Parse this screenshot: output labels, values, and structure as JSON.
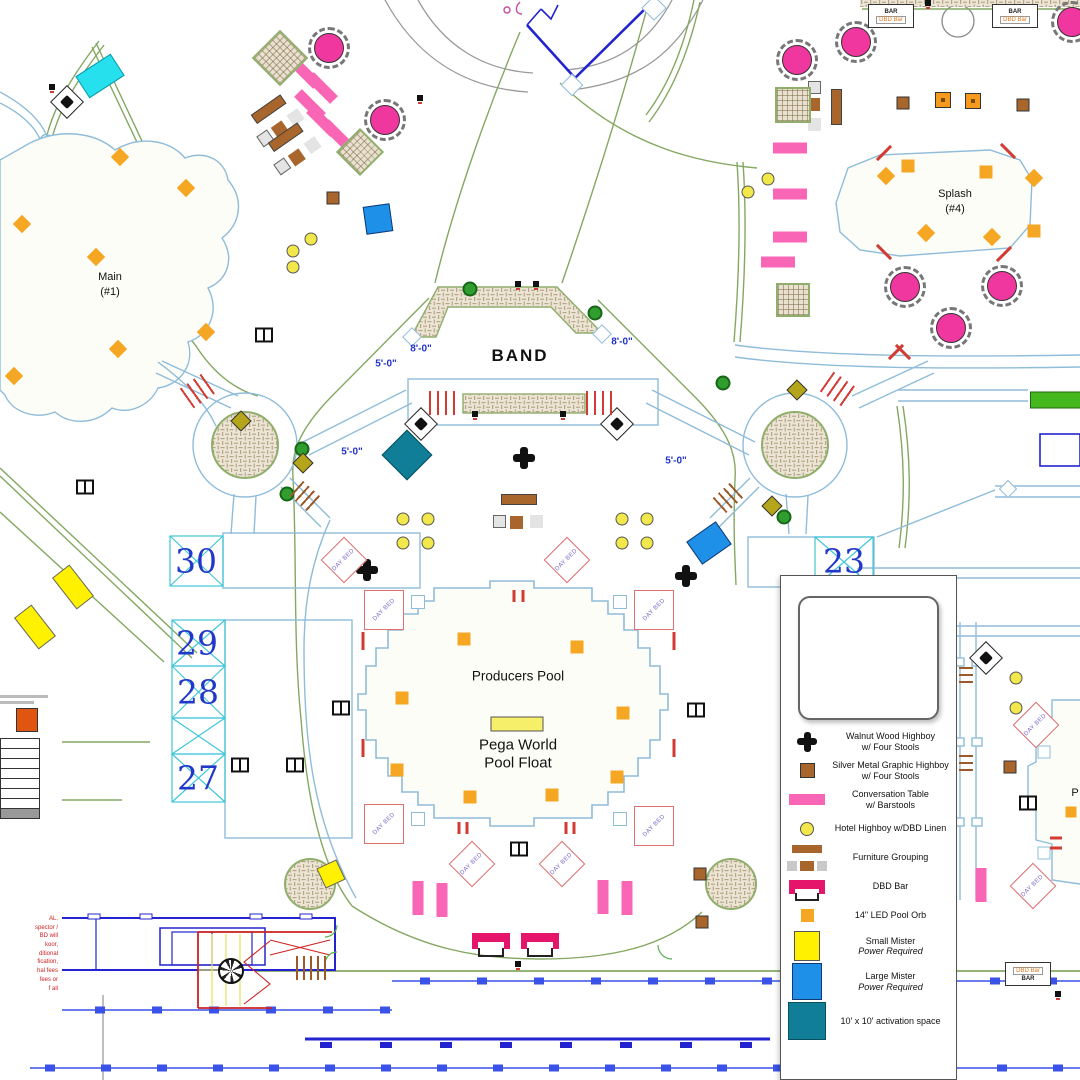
{
  "colors": {
    "pink": "#f966b5",
    "magenta_table": "#f0379f",
    "dbd_bar": "#e4156b",
    "orb_orange": "#f5a623",
    "brown": "#a9662c",
    "small_mister": "#fff100",
    "large_mister": "#1e90e8",
    "activation": "#0f7e96",
    "walk_green": "#84a861",
    "water_blue": "#8fbcd9",
    "cad_blue": "#2323cf",
    "cabana_num": "#2238c8",
    "red": "#d23b33"
  },
  "day_bed_text": "DAY BED",
  "bar_icon": {
    "bar": "BAR",
    "dbd": "DBD Bar"
  },
  "labels": [
    {
      "text": "BAND",
      "x": 520,
      "y": 356,
      "cls": "band"
    },
    {
      "text": "Producers Pool",
      "x": 518,
      "y": 676,
      "cls": "pool"
    },
    {
      "text": "Pega World",
      "x": 518,
      "y": 745,
      "cls": "float"
    },
    {
      "text": "Pool Float",
      "x": 518,
      "y": 763,
      "cls": "float"
    },
    {
      "text": "Main",
      "x": 110,
      "y": 277,
      "cls": "small"
    },
    {
      "text": "(#1)",
      "x": 110,
      "y": 292,
      "cls": "small"
    },
    {
      "text": "Splash",
      "x": 955,
      "y": 194,
      "cls": "small"
    },
    {
      "text": "(#4)",
      "x": 955,
      "y": 209,
      "cls": "small"
    },
    {
      "text": "30",
      "x": 196,
      "y": 561,
      "cls": "cab"
    },
    {
      "text": "29",
      "x": 197,
      "y": 643,
      "cls": "cab"
    },
    {
      "text": "28",
      "x": 198,
      "y": 692,
      "cls": "cab"
    },
    {
      "text": "27",
      "x": 198,
      "y": 778,
      "cls": "cab"
    },
    {
      "text": "23",
      "x": 844,
      "y": 561,
      "cls": "cab"
    },
    {
      "text": "8'-0\"",
      "x": 421,
      "y": 349,
      "cls": "dim"
    },
    {
      "text": "8'-0\"",
      "x": 622,
      "y": 342,
      "cls": "dim"
    },
    {
      "text": "5'-0\"",
      "x": 386,
      "y": 364,
      "cls": "dim"
    },
    {
      "text": "5'-0\"",
      "x": 352,
      "y": 452,
      "cls": "dim"
    },
    {
      "text": "5'-0\"",
      "x": 676,
      "y": 461,
      "cls": "dim"
    },
    {
      "text": "P",
      "x": 1075,
      "y": 793,
      "cls": "small"
    }
  ],
  "legend": {
    "items": [
      {
        "swatch": "plus",
        "line1": "Walnut Wood Highboy",
        "line2": "w/ Four Stools"
      },
      {
        "swatch": "brown",
        "line1": "Silver Metal Graphic Highboy",
        "line2": "w/ Four Stools"
      },
      {
        "swatch": "pink",
        "line1": "Conversation Table",
        "line2": "w/ Barstools"
      },
      {
        "swatch": "ycirc",
        "line1": "Hotel Highboy w/DBD Linen"
      },
      {
        "swatch": "furn",
        "line1": "Furniture Grouping"
      },
      {
        "swatch": "dbd",
        "line1": "DBD Bar"
      },
      {
        "swatch": "orange",
        "line1": "14\" LED Pool Orb"
      },
      {
        "swatch": "yrect",
        "line1": "Small Mister",
        "line2": "Power Required",
        "italic2": true
      },
      {
        "swatch": "brect",
        "line1": "Large Mister",
        "line2": "Power Required",
        "italic2": true
      },
      {
        "swatch": "teal",
        "line1": "10' x 10' activation space"
      }
    ]
  },
  "notes_panel": {
    "table_rows": 8,
    "red_fragments": [
      "AL.",
      "spector /",
      "BD will",
      "koor,",
      "ditional",
      "fication,",
      "hal fees",
      "fees or",
      "f all"
    ]
  },
  "markers": [
    {
      "t": "orb",
      "x": 464,
      "y": 639
    },
    {
      "t": "orb",
      "x": 577,
      "y": 647
    },
    {
      "t": "orb",
      "x": 402,
      "y": 698
    },
    {
      "t": "orb",
      "x": 623,
      "y": 713
    },
    {
      "t": "orb",
      "x": 397,
      "y": 770
    },
    {
      "t": "orb",
      "x": 617,
      "y": 777
    },
    {
      "t": "orb",
      "x": 470,
      "y": 797
    },
    {
      "t": "orb",
      "x": 552,
      "y": 795
    },
    {
      "t": "orb",
      "x": 1071,
      "y": 812,
      "w": 11,
      "h": 11
    },
    {
      "t": "orbd",
      "x": 120,
      "y": 157,
      "r": 45
    },
    {
      "t": "orbd",
      "x": 22,
      "y": 224,
      "r": 45
    },
    {
      "t": "orbd",
      "x": 96,
      "y": 257,
      "r": 45
    },
    {
      "t": "orbd",
      "x": 14,
      "y": 376,
      "r": 45
    },
    {
      "t": "orbd",
      "x": 118,
      "y": 349,
      "r": 45
    },
    {
      "t": "orbd",
      "x": 206,
      "y": 332,
      "r": 45
    },
    {
      "t": "orbd",
      "x": 186,
      "y": 188,
      "r": 45
    },
    {
      "t": "orbd",
      "x": 886,
      "y": 176,
      "r": 45
    },
    {
      "t": "orb",
      "x": 908,
      "y": 166
    },
    {
      "t": "orb",
      "x": 986,
      "y": 172
    },
    {
      "t": "orbd",
      "x": 1034,
      "y": 178,
      "r": 45
    },
    {
      "t": "orbd",
      "x": 926,
      "y": 233,
      "r": 45
    },
    {
      "t": "orbd",
      "x": 992,
      "y": 237,
      "r": 45
    },
    {
      "t": "orb",
      "x": 1034,
      "y": 231
    },
    {
      "t": "float",
      "x": 517,
      "y": 724
    },
    {
      "t": "ptable",
      "x": 329,
      "y": 48
    },
    {
      "t": "ptable",
      "x": 385,
      "y": 120
    },
    {
      "t": "ptable",
      "x": 797,
      "y": 60
    },
    {
      "t": "ptable",
      "x": 856,
      "y": 42
    },
    {
      "t": "ptable",
      "x": 1072,
      "y": 22
    },
    {
      "t": "ptable",
      "x": 905,
      "y": 287
    },
    {
      "t": "ptable",
      "x": 951,
      "y": 328
    },
    {
      "t": "ptable",
      "x": 1002,
      "y": 286
    },
    {
      "t": "conv",
      "x": 305,
      "y": 73,
      "r": 45
    },
    {
      "t": "conv",
      "x": 322,
      "y": 88,
      "r": 45
    },
    {
      "t": "conv",
      "x": 310,
      "y": 105,
      "r": 45
    },
    {
      "t": "conv",
      "x": 322,
      "y": 121,
      "r": 45
    },
    {
      "t": "conv",
      "x": 337,
      "y": 135,
      "r": 45
    },
    {
      "t": "conv",
      "x": 790,
      "y": 148
    },
    {
      "t": "conv",
      "x": 790,
      "y": 194
    },
    {
      "t": "conv",
      "x": 790,
      "y": 237
    },
    {
      "t": "conv",
      "x": 778,
      "y": 262
    },
    {
      "t": "conv",
      "x": 418,
      "y": 898,
      "r": 90
    },
    {
      "t": "conv",
      "x": 442,
      "y": 900,
      "r": 90
    },
    {
      "t": "conv",
      "x": 603,
      "y": 897,
      "r": 90
    },
    {
      "t": "conv",
      "x": 627,
      "y": 898,
      "r": 90
    },
    {
      "t": "conv",
      "x": 981,
      "y": 885,
      "r": 90
    },
    {
      "t": "tree",
      "x": 470,
      "y": 289
    },
    {
      "t": "tree",
      "x": 595,
      "y": 313
    },
    {
      "t": "tree",
      "x": 723,
      "y": 383
    },
    {
      "t": "tree",
      "x": 302,
      "y": 449
    },
    {
      "t": "tree",
      "x": 287,
      "y": 494
    },
    {
      "t": "tree",
      "x": 784,
      "y": 517
    },
    {
      "t": "ybh",
      "x": 403,
      "y": 519
    },
    {
      "t": "ybh",
      "x": 428,
      "y": 519
    },
    {
      "t": "ybh",
      "x": 403,
      "y": 543
    },
    {
      "t": "ybh",
      "x": 428,
      "y": 543
    },
    {
      "t": "ybh",
      "x": 622,
      "y": 519
    },
    {
      "t": "ybh",
      "x": 647,
      "y": 519
    },
    {
      "t": "ybh",
      "x": 622,
      "y": 543
    },
    {
      "t": "ybh",
      "x": 647,
      "y": 543
    },
    {
      "t": "ybh",
      "x": 293,
      "y": 251
    },
    {
      "t": "ybh",
      "x": 311,
      "y": 239
    },
    {
      "t": "ybh",
      "x": 293,
      "y": 267
    },
    {
      "t": "ybh",
      "x": 748,
      "y": 192
    },
    {
      "t": "ybh",
      "x": 768,
      "y": 179
    },
    {
      "t": "ybh",
      "x": 1016,
      "y": 678
    },
    {
      "t": "ybh",
      "x": 1016,
      "y": 708
    },
    {
      "t": "olive",
      "x": 241,
      "y": 421,
      "r": 45
    },
    {
      "t": "olive",
      "x": 303,
      "y": 463,
      "r": 45
    },
    {
      "t": "olive",
      "x": 797,
      "y": 390,
      "r": 45
    },
    {
      "t": "olive",
      "x": 772,
      "y": 506,
      "r": 45
    },
    {
      "t": "plus",
      "x": 524,
      "y": 458
    },
    {
      "t": "plus",
      "x": 367,
      "y": 570
    },
    {
      "t": "plus",
      "x": 686,
      "y": 576
    },
    {
      "t": "daybed",
      "x": 384,
      "y": 610
    },
    {
      "t": "daybed",
      "x": 654,
      "y": 610
    },
    {
      "t": "daybed",
      "x": 384,
      "y": 824
    },
    {
      "t": "daybed",
      "x": 654,
      "y": 826
    },
    {
      "t": "daybedd",
      "x": 472,
      "y": 864,
      "r": 45
    },
    {
      "t": "daybedd",
      "x": 562,
      "y": 864,
      "r": 45
    },
    {
      "t": "daybedd",
      "x": 344,
      "y": 560,
      "r": 45
    },
    {
      "t": "daybedd",
      "x": 567,
      "y": 560,
      "r": 45
    },
    {
      "t": "daybedd",
      "x": 1036,
      "y": 725,
      "r": 45
    },
    {
      "t": "daybedd",
      "x": 1033,
      "y": 886,
      "r": 45
    },
    {
      "t": "bluesq",
      "x": 418,
      "y": 602
    },
    {
      "t": "bluesq",
      "x": 620,
      "y": 602
    },
    {
      "t": "bluesq",
      "x": 418,
      "y": 819
    },
    {
      "t": "bluesq",
      "x": 620,
      "y": 819
    },
    {
      "t": "bluesq",
      "x": 1044,
      "y": 752,
      "w": 13,
      "h": 13
    },
    {
      "t": "bluesq",
      "x": 1044,
      "y": 853,
      "w": 13,
      "h": 13
    },
    {
      "t": "bluesq",
      "x": 51,
      "y": 846,
      "w": 12,
      "h": 12
    },
    {
      "t": "bluesq",
      "x": 50,
      "y": 893,
      "w": 12,
      "h": 12
    },
    {
      "t": "bluesq",
      "x": 572,
      "y": 85,
      "w": 16,
      "h": 16,
      "r": 45
    },
    {
      "t": "bluesq",
      "x": 654,
      "y": 8,
      "w": 18,
      "h": 18,
      "r": 45
    },
    {
      "t": "bluesq",
      "x": 412,
      "y": 337,
      "w": 14,
      "h": 14,
      "r": 45
    },
    {
      "t": "bluesq",
      "x": 602,
      "y": 334,
      "w": 14,
      "h": 14,
      "r": 45
    },
    {
      "t": "bluesq",
      "x": 1008,
      "y": 489,
      "w": 13,
      "h": 13,
      "r": 45
    },
    {
      "t": "ymist",
      "x": 73,
      "y": 587,
      "r": -38
    },
    {
      "t": "ymist",
      "x": 35,
      "y": 627,
      "r": -38
    },
    {
      "t": "ymist",
      "x": 331,
      "y": 874,
      "w": 22,
      "h": 22,
      "r": -25
    },
    {
      "t": "cmist",
      "x": 100,
      "y": 76,
      "r": -33
    },
    {
      "t": "bmist",
      "x": 378,
      "y": 219,
      "r": -8
    },
    {
      "t": "bmist",
      "x": 709,
      "y": 543,
      "w": 36,
      "h": 28,
      "r": -35
    },
    {
      "t": "act",
      "x": 407,
      "y": 455,
      "r": 45
    },
    {
      "t": "dbdbar",
      "x": 491,
      "y": 941
    },
    {
      "t": "dbdbar",
      "x": 540,
      "y": 941
    },
    {
      "t": "baricon",
      "x": 891,
      "y": 16
    },
    {
      "t": "baricon",
      "x": 1015,
      "y": 16
    },
    {
      "t": "baricon2",
      "x": 1028,
      "y": 974
    },
    {
      "t": "tv",
      "x": 264,
      "y": 335
    },
    {
      "t": "tv",
      "x": 85,
      "y": 487
    },
    {
      "t": "tv",
      "x": 240,
      "y": 765
    },
    {
      "t": "tv",
      "x": 295,
      "y": 765
    },
    {
      "t": "tv",
      "x": 341,
      "y": 708
    },
    {
      "t": "tv",
      "x": 696,
      "y": 710
    },
    {
      "t": "tv",
      "x": 519,
      "y": 849
    },
    {
      "t": "tv",
      "x": 1028,
      "y": 803
    },
    {
      "t": "spk",
      "x": 67,
      "y": 102,
      "r": 45
    },
    {
      "t": "spk",
      "x": 421,
      "y": 424,
      "r": 45
    },
    {
      "t": "spk",
      "x": 617,
      "y": 424,
      "r": 45
    },
    {
      "t": "spk",
      "x": 986,
      "y": 658,
      "r": 45
    },
    {
      "t": "sofa",
      "x": 275,
      "y": 120,
      "r": -35
    },
    {
      "t": "sofa",
      "x": 292,
      "y": 148,
      "r": -35
    },
    {
      "t": "sofa",
      "x": 824,
      "y": 106,
      "r": 90
    },
    {
      "t": "sofa",
      "x": 518,
      "y": 512
    },
    {
      "t": "hatchd",
      "x": 280,
      "y": 58,
      "w": 40,
      "h": 40,
      "r": 45
    },
    {
      "t": "hatchd",
      "x": 360,
      "y": 152,
      "w": 34,
      "h": 34,
      "r": 45
    },
    {
      "t": "hatchd",
      "x": 793,
      "y": 105,
      "w": 36,
      "h": 36
    },
    {
      "t": "hatchd",
      "x": 793,
      "y": 300,
      "w": 34,
      "h": 34
    },
    {
      "t": "bsq",
      "x": 903,
      "y": 103
    },
    {
      "t": "bsq",
      "x": 1023,
      "y": 105
    },
    {
      "t": "bsq",
      "x": 700,
      "y": 874
    },
    {
      "t": "bsq",
      "x": 702,
      "y": 922
    },
    {
      "t": "bsq",
      "x": 333,
      "y": 198
    },
    {
      "t": "bsq",
      "x": 1010,
      "y": 767
    },
    {
      "t": "obox",
      "x": 943,
      "y": 100
    },
    {
      "t": "obox",
      "x": 973,
      "y": 101
    },
    {
      "t": "esym",
      "x": 518,
      "y": 284
    },
    {
      "t": "esym",
      "x": 536,
      "y": 284
    },
    {
      "t": "esym",
      "x": 475,
      "y": 414
    },
    {
      "t": "esym",
      "x": 563,
      "y": 414
    },
    {
      "t": "esym",
      "x": 518,
      "y": 964
    },
    {
      "t": "esym",
      "x": 848,
      "y": 964
    },
    {
      "t": "esym",
      "x": 1058,
      "y": 994
    },
    {
      "t": "esym",
      "x": 420,
      "y": 98
    },
    {
      "t": "esym",
      "x": 928,
      "y": 3
    },
    {
      "t": "esym",
      "x": 52,
      "y": 87
    },
    {
      "t": "redtick",
      "x": 363,
      "y": 641
    },
    {
      "t": "redtick",
      "x": 363,
      "y": 748
    },
    {
      "t": "redtick",
      "x": 674,
      "y": 641
    },
    {
      "t": "redtick",
      "x": 674,
      "y": 748
    },
    {
      "t": "redtick",
      "x": 514,
      "y": 596,
      "h": 12
    },
    {
      "t": "redtick",
      "x": 523,
      "y": 596,
      "h": 12
    },
    {
      "t": "redtick",
      "x": 459,
      "y": 828,
      "h": 12
    },
    {
      "t": "redtick",
      "x": 467,
      "y": 828,
      "h": 12
    },
    {
      "t": "redtick",
      "x": 566,
      "y": 828,
      "h": 12
    },
    {
      "t": "redtick",
      "x": 574,
      "y": 828,
      "h": 12
    },
    {
      "t": "redtick",
      "x": 884,
      "y": 153,
      "h": 20,
      "r": 45
    },
    {
      "t": "redtick",
      "x": 1008,
      "y": 151,
      "h": 20,
      "r": -45
    },
    {
      "t": "redtick",
      "x": 884,
      "y": 252,
      "h": 20,
      "r": -45
    },
    {
      "t": "redtick",
      "x": 1004,
      "y": 254,
      "h": 20,
      "r": 45
    },
    {
      "t": "redtick",
      "x": 896,
      "y": 352,
      "h": 20,
      "r": 45
    },
    {
      "t": "redtick",
      "x": 903,
      "y": 352,
      "h": 20,
      "r": -45
    },
    {
      "t": "redtick",
      "x": 1056,
      "y": 838,
      "h": 12,
      "r": 90
    },
    {
      "t": "redtick",
      "x": 1056,
      "y": 848,
      "h": 12,
      "r": 90
    },
    {
      "t": "redstripes",
      "x": 199,
      "y": 390,
      "r": -35
    },
    {
      "t": "redstripes",
      "x": 839,
      "y": 390,
      "r": 35
    },
    {
      "t": "redstripes",
      "x": 444,
      "y": 403
    },
    {
      "t": "redstripes",
      "x": 599,
      "y": 403,
      "w": 26
    },
    {
      "t": "brownstripes",
      "x": 306,
      "y": 497,
      "r": 42
    },
    {
      "t": "brownstripes",
      "x": 729,
      "y": 497,
      "r": -42
    },
    {
      "t": "brownstripes",
      "x": 313,
      "y": 968,
      "w": 34,
      "h": 24
    },
    {
      "t": "brownstripes",
      "x": 966,
      "y": 676,
      "w": 18,
      "h": 14,
      "r": 90
    },
    {
      "t": "brownstripes",
      "x": 966,
      "y": 764,
      "w": 18,
      "h": 14,
      "r": 90
    },
    {
      "t": "fan",
      "x": 231,
      "y": 971
    },
    {
      "t": "greenrect",
      "x": 1056,
      "y": 400
    }
  ]
}
